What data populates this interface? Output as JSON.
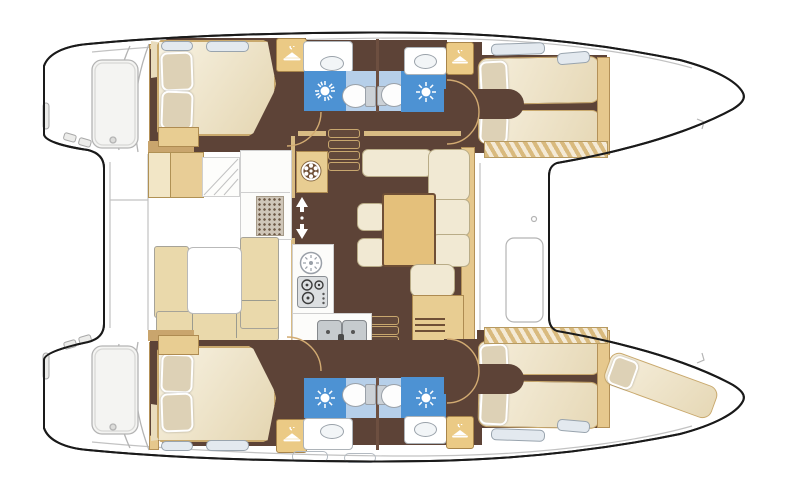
{
  "plan": {
    "title": "Catamaran interior layout floor plan",
    "orientation": {
      "bow": "right",
      "stern": "left"
    },
    "summary": {
      "cabins": 4,
      "heads": 4,
      "showers": 4,
      "toilets": 4,
      "wardrobes": 4,
      "forepeak_berths": 1
    },
    "cockpit": {
      "features": [
        "u-shaped-settee",
        "cockpit-table",
        "side-module",
        "deck-grate",
        "deck-steps",
        "transom-platforms",
        "helm-lockers"
      ]
    },
    "saloon": {
      "features": [
        "l-shaped-settee",
        "saloon-table",
        "stools",
        "lounge-seat",
        "aft-cabinet",
        "vent-unit",
        "sliding-door-arrows"
      ],
      "galley": [
        "round-hob",
        "stove-burners",
        "double-sink"
      ],
      "companionways": [
        "steps-to-port-hull",
        "steps-to-starboard-hull"
      ]
    },
    "port_hull": {
      "aft_cabin": [
        "double-bed",
        "pillows",
        "nightstand",
        "wardrobe",
        "head-shower",
        "toilet",
        "washbasin"
      ],
      "fwd_cabin": [
        "twin-berths",
        "pillows",
        "wardrobe",
        "head-shower",
        "toilet",
        "washbasin"
      ]
    },
    "starboard_hull": {
      "aft_cabin": [
        "double-bed",
        "pillows",
        "nightstand",
        "wardrobe",
        "head-shower",
        "toilet",
        "washbasin"
      ],
      "fwd_cabin": [
        "twin-berths",
        "pillows",
        "wardrobe",
        "head-shower",
        "toilet",
        "washbasin"
      ],
      "forepeak": [
        "crew-berth",
        "pillow"
      ]
    },
    "icons": [
      "hanger-icon",
      "shower-rose-icon",
      "vent-fan-icon",
      "companionway-arrows-icon"
    ]
  },
  "colors": {
    "hull_outline": "#1a1a1a",
    "detail_grey": "#b9b9b9",
    "floor_brown": "#5d4337",
    "wood_tan": "#e6c88d",
    "upholstery_cream": "#f1e9d3",
    "shower_blue": "#4d92d3",
    "bath_pale_blue": "#b6cfe9",
    "fixture_white": "#ffffff"
  }
}
